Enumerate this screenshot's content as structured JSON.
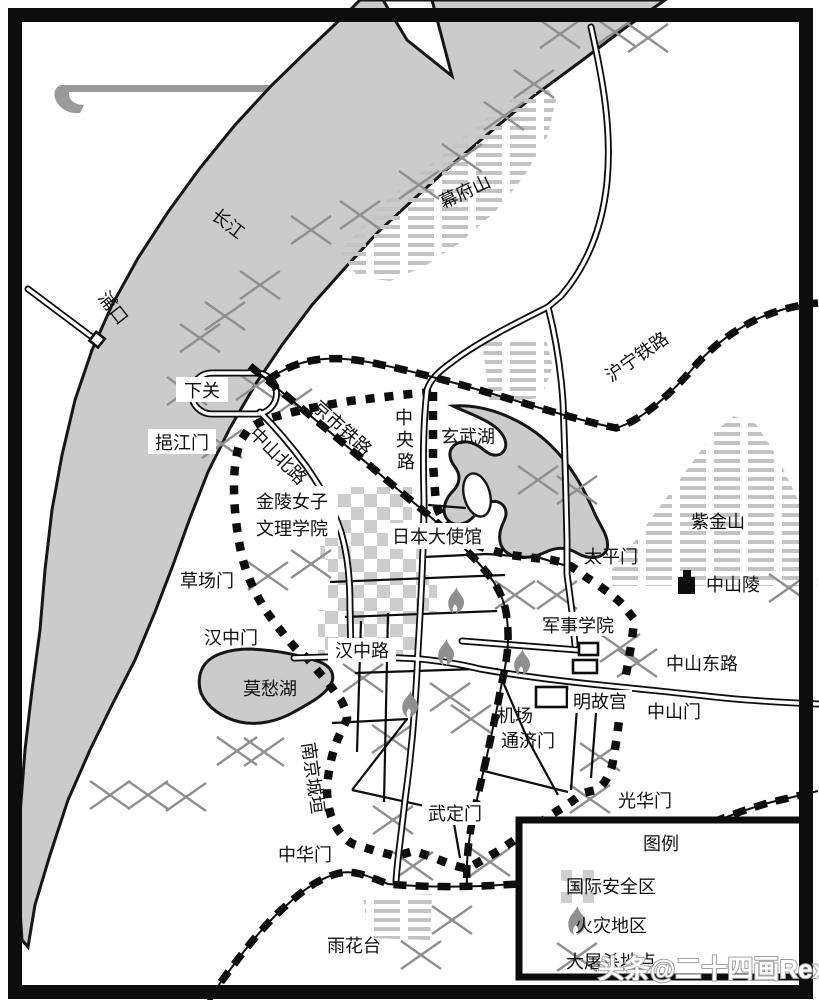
{
  "map": {
    "region_labels": {
      "changjiang": "长江",
      "pukou": "浦口",
      "mufushan": "幕府山",
      "zijinshan": "紫金山",
      "yuhuatai": "雨花台",
      "xuanwu_lake": "玄武湖",
      "mochou_lake": "莫愁湖"
    },
    "railway_labels": {
      "jingshi": "京市铁路",
      "huning": "沪宁铁路"
    },
    "road_labels": {
      "zhongshan_north": "中山北路",
      "zhongyang_c1": "中",
      "zhongyang_c2": "央",
      "zhongyang_c3": "路",
      "hanzhong": "汉中路",
      "zhongshan_east": "中山东路"
    },
    "gate_labels": {
      "xiaguan": "下关",
      "yijiangmen": "挹江门",
      "caochangmen": "草场门",
      "hanzhongmen": "汉中门",
      "taipingmen": "太平门",
      "zhongshanmen": "中山门",
      "tongjimen": "通济门",
      "guanghuamen": "光华门",
      "wudingmen": "武定门",
      "zhonghuamen": "中华门"
    },
    "site_labels": {
      "jinling_college_line1": "金陵女子",
      "jinling_college_line2": "文理学院",
      "japanese_embassy": "日本大使馆",
      "military_academy": "军事学院",
      "ming_palace": "明故宫",
      "airport": "机场",
      "zhongshanling": "中山陵",
      "nanjing_wall": "南京城垣"
    },
    "legend": {
      "title": "图例",
      "safety_zone": "国际安全区",
      "fire_area": "火灾地区",
      "massacre_site": "大屠杀地点"
    },
    "watermark": "头条@二十四画Rex",
    "colors": {
      "water": "#cbcbcb",
      "hatch": "#c3c3c3",
      "marks": "#8f8f8f",
      "ink": "#0d0d0d"
    }
  }
}
